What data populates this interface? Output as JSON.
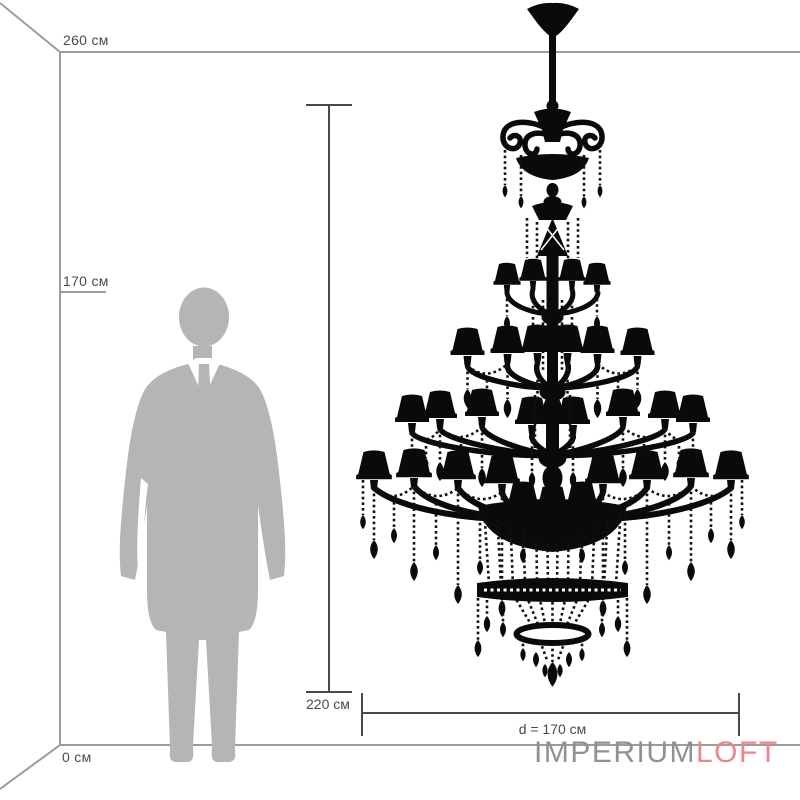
{
  "scale": {
    "top_label": "260 см",
    "person_label": "170 см",
    "floor_label": "0 см"
  },
  "dimensions": {
    "height": "220 см",
    "diameter": "d = 170 см"
  },
  "logo": {
    "gray_part": "IMPERIUM",
    "accent_part": "LOFT"
  },
  "colors": {
    "room_line": "#9c9c9c",
    "dimension_line": "#4a4a4a",
    "label_text": "#4a4a4a",
    "silhouette": "#b5b5b5",
    "chandelier": "#0a0a0a",
    "logo_gray": "#8f9194",
    "logo_accent": "#ee848a"
  }
}
